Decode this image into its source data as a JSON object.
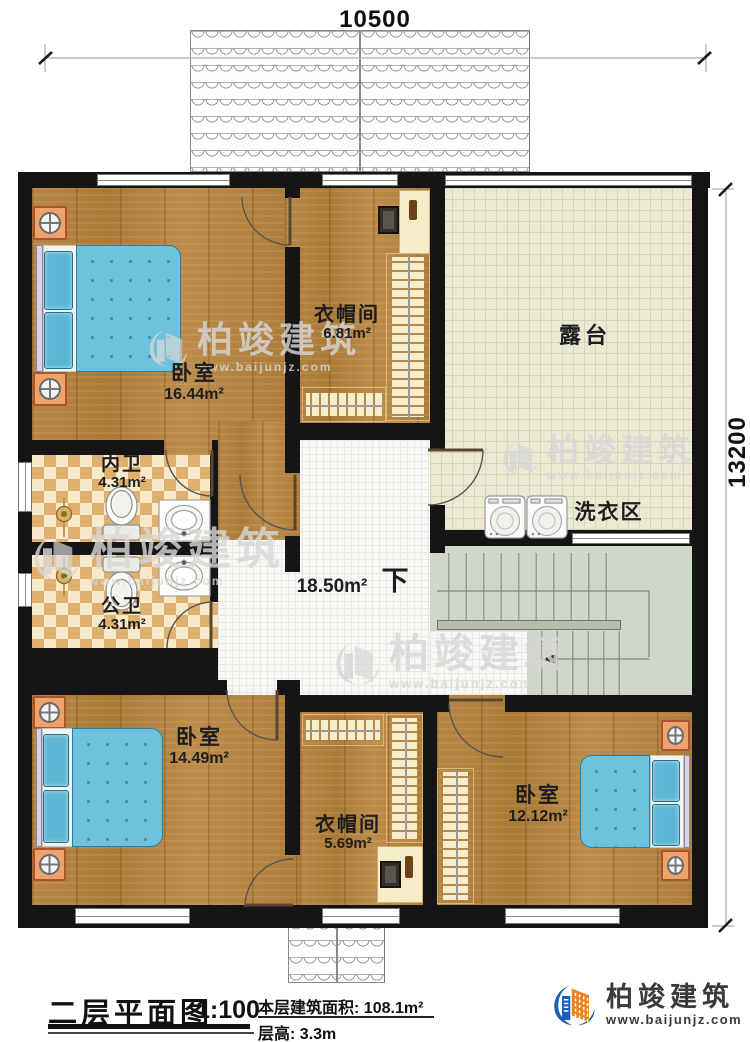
{
  "dimensions": {
    "width_mm": "10500",
    "height_mm": "13200"
  },
  "rooms": {
    "bedroom_master": {
      "label": "卧室",
      "area": "16.44m²"
    },
    "cloakroom_top": {
      "label": "衣帽间",
      "area": "6.81m²"
    },
    "terrace": {
      "label": "露台"
    },
    "laundry": {
      "label": "洗衣区"
    },
    "bath_private": {
      "label": "内卫",
      "area": "4.31m²"
    },
    "bath_public": {
      "label": "公卫",
      "area": "4.31m²"
    },
    "hall": {
      "area": "18.50m²",
      "stairs_label": "下"
    },
    "bedroom_left": {
      "label": "卧室",
      "area": "14.49m²"
    },
    "cloakroom_bottom": {
      "label": "衣帽间",
      "area": "5.69m²"
    },
    "bedroom_right": {
      "label": "卧室",
      "area": "12.12m²"
    }
  },
  "title_block": {
    "title": "二层平面图",
    "scale": "1:100",
    "area_label": "本层建筑面积:",
    "area_value": "108.1m²",
    "height_label": "层高:",
    "height_value": "3.3m"
  },
  "brand": {
    "name": "柏竣建筑",
    "website": "www.baijunjz.com"
  },
  "watermark": {
    "name": "柏竣建筑",
    "website": "www.baijunjz.com"
  },
  "colors": {
    "wall": "#151515",
    "wood_floor": "#b2813e",
    "bath_tile": "#dfb070",
    "terrace_tile": "#ebe8d4",
    "stairs": "#cfd6ca",
    "bed_blue": "#6fc2dc",
    "logo_blue": "#1a5fb5",
    "logo_orange": "#e88420"
  }
}
